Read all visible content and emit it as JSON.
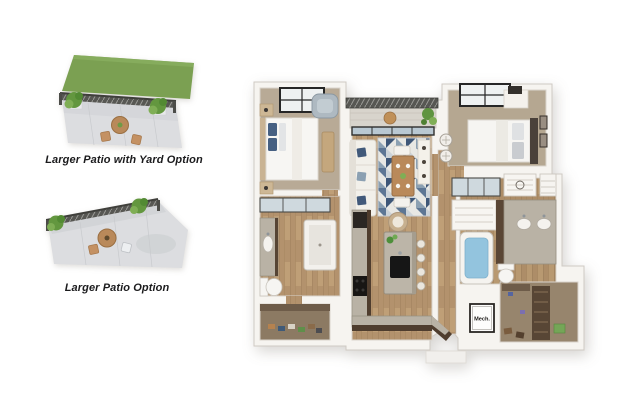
{
  "page": {
    "background": "#ffffff"
  },
  "patio_options": [
    {
      "caption": "Larger Patio with Yard Option"
    },
    {
      "caption": "Larger Patio Option"
    }
  ],
  "floor_plan": {
    "labels": {
      "mech_room": "Mech."
    }
  },
  "colors": {
    "background": "#ffffff",
    "yard_green": "#7ba052",
    "plant_green": "#63973f",
    "patio_concrete": "#dcdde0",
    "railing_gray": "#575753",
    "wall_white": "#f6f4f0",
    "wood_floor": "#b3926d",
    "carpet_tan": "#b8aa96",
    "closet_carpet": "#8c7a63",
    "counter_brown": "#4f3d2e",
    "granite_gray": "#b9b2a5",
    "rug_navy": "#3e5778",
    "rug_blue": "#8ba0b2",
    "tub_water_blue": "#93c4de",
    "table_wood": "#b9895a"
  }
}
